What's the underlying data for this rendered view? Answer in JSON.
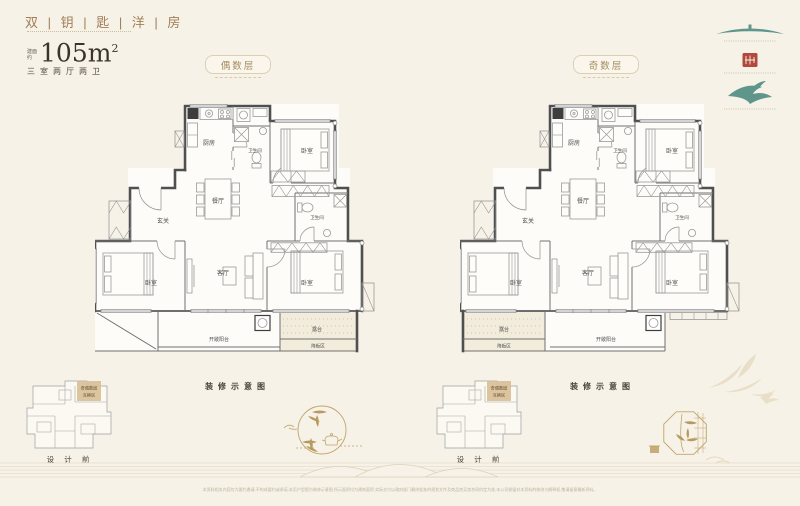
{
  "header": {
    "title": "双 | 钥 | 匙 | 洋 | 房",
    "area_label_top": "建面",
    "area_label_bottom": "约",
    "area_value": "105m",
    "area_sup": "2",
    "spec": "三室两厅两卫"
  },
  "plans": [
    {
      "badge": "偶数层",
      "caption": "装修示意图",
      "rooms": {
        "kitchen": "厨房",
        "bath1": "卫生间",
        "bed1": "卧室",
        "dining": "餐厅",
        "foyer": "玄关",
        "bath2": "卫生间",
        "bed2": "卧室",
        "living": "客厅",
        "bed3": "卧室",
        "balcony": "开敞阳台",
        "terrace": "露台",
        "sunken": "降板区"
      }
    },
    {
      "badge": "奇数层",
      "caption": "装修示意图",
      "rooms": {
        "kitchen": "厨房",
        "bath1": "卫生间",
        "bed1": "卧室",
        "dining": "餐厅",
        "foyer": "玄关",
        "bath2": "卫生间",
        "bed2": "卧室",
        "living": "客厅",
        "bed3": "卧室",
        "balcony": "开敞阳台",
        "terrace": "露台",
        "sunken": "降板区"
      }
    }
  ],
  "mini_plans": [
    {
      "label": "设 计 前",
      "tag_line1": "奇偶数层",
      "tag_line2": "互换区"
    },
    {
      "label": "设 计 前",
      "tag_line1": "奇偶数层",
      "tag_line2": "互换区"
    }
  ],
  "footer": {
    "disclaimer": "本资料相关内容仅为要约邀请,不构成要约或承诺;本页户型图为装修示意图,所示面积均为建筑面积,实际交付以政府部门最终批准的规划文件及商品房买卖合同约定为准;本公司保留对本资料的修改与解释权,敬请留意最新资料。"
  },
  "colors": {
    "background": "#f7f2e8",
    "accent_gold": "#b99a5f",
    "logo_teal": "#5f968c",
    "seal_red": "#b2493c",
    "wall_gray": "#4f4f4f"
  }
}
